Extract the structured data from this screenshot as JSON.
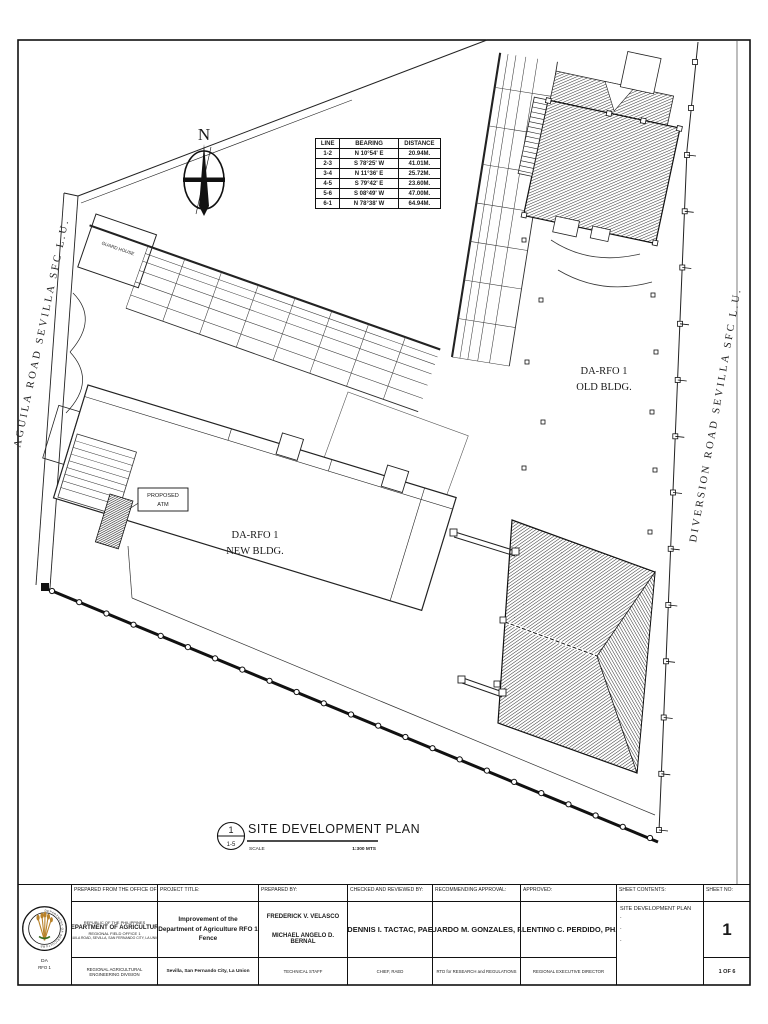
{
  "colors": {
    "ink": "#1a1a1a",
    "paper": "#ffffff",
    "wheat_gold": "#b8822b",
    "leaf_green": "#3c6e22"
  },
  "north_label": "N",
  "roads": {
    "left": "AGUILA ROAD SEVILLA SFC L.U.",
    "right": "DIVERSION ROAD SEVILLA SFC L.U."
  },
  "labels": {
    "old_bldg": [
      "DA-RFO 1",
      "OLD BLDG."
    ],
    "new_bldg": [
      "DA-RFO 1",
      "NEW BLDG."
    ],
    "guard_house": "GUARD HOUSE",
    "atm": [
      "PROPOSED",
      "ATM"
    ]
  },
  "traverse_table": {
    "headers": [
      "LINE",
      "BEARING",
      "DISTANCE"
    ],
    "rows": [
      [
        "1-2",
        "N 10°54' E",
        "20.94M."
      ],
      [
        "2-3",
        "S 78°25' W",
        "41.01M."
      ],
      [
        "3-4",
        "N 11°36' E",
        "25.72M."
      ],
      [
        "4-5",
        "S 79°42' E",
        "23.60M."
      ],
      [
        "5-6",
        "S 08°49' W",
        "47.00M."
      ],
      [
        "6-1",
        "N 78°38' W",
        "64.94M."
      ]
    ]
  },
  "sheet": {
    "detail_number": "1",
    "detail_ref": "1-5",
    "title": "SITE DEVELOPMENT PLAN",
    "scale_label": "SCALE",
    "scale_value": "1:300 MTS"
  },
  "title_block": {
    "logo": {
      "ring_text": "DEPARTMENT OF AGRICULTURE",
      "caption1": "DA",
      "caption2": "RFO 1"
    },
    "office": {
      "label": "PREPARED FROM THE OFFICE OF:",
      "line1": "REPUBLIC OF THE PHILIPPINES",
      "line2": "DEPARTMENT OF AGRICULTURE",
      "line3": "REGIONAL FIELD OFFICE 1",
      "line4": "AGUILA ROAD, SEVILLA, SAN FERNANDO CITY, LA UNION",
      "line5": "REGIONAL AGRICULTURAL ENGINEERING DIVISION"
    },
    "project": {
      "label": "PROJECT TITLE:",
      "title_line1": "Improvement of the",
      "title_line2": "Department of Agriculture  RFO 1",
      "title_line3": "Fence",
      "location": "Sevilla, San Fernando City, La Union"
    },
    "prepared_by": {
      "label": "PREPARED BY:",
      "name1": "FREDERICK V. VELASCO",
      "name2": "MICHAEL ANGELO D. BERNAL",
      "position": "TECHNICAL STAFF"
    },
    "checked": {
      "label": "CHECKED AND REVIEWED BY:",
      "name": "DENNIS I. TACTAC, PAE",
      "position": "CHIEF, RAED"
    },
    "recommending": {
      "label": "RECOMMENDING APPROVAL:",
      "name": "EDUARDO M. GONZALES, PAE",
      "position": "RTD for RESEARCH and REGULATIONS"
    },
    "approved": {
      "label": "APPROVED:",
      "name": "VALENTINO C. PERDIDO, PH.D.",
      "position": "REGIONAL EXECUTIVE DIRECTOR"
    },
    "sheet_contents": {
      "label": "SHEET CONTENTS:",
      "content": "SITE DEVELOPMENT PLAN",
      "bullets": [
        ".",
        ".",
        "."
      ]
    },
    "sheet_no": {
      "label": "SHEET NO:",
      "number": "1",
      "total": "1 OF 6"
    }
  }
}
